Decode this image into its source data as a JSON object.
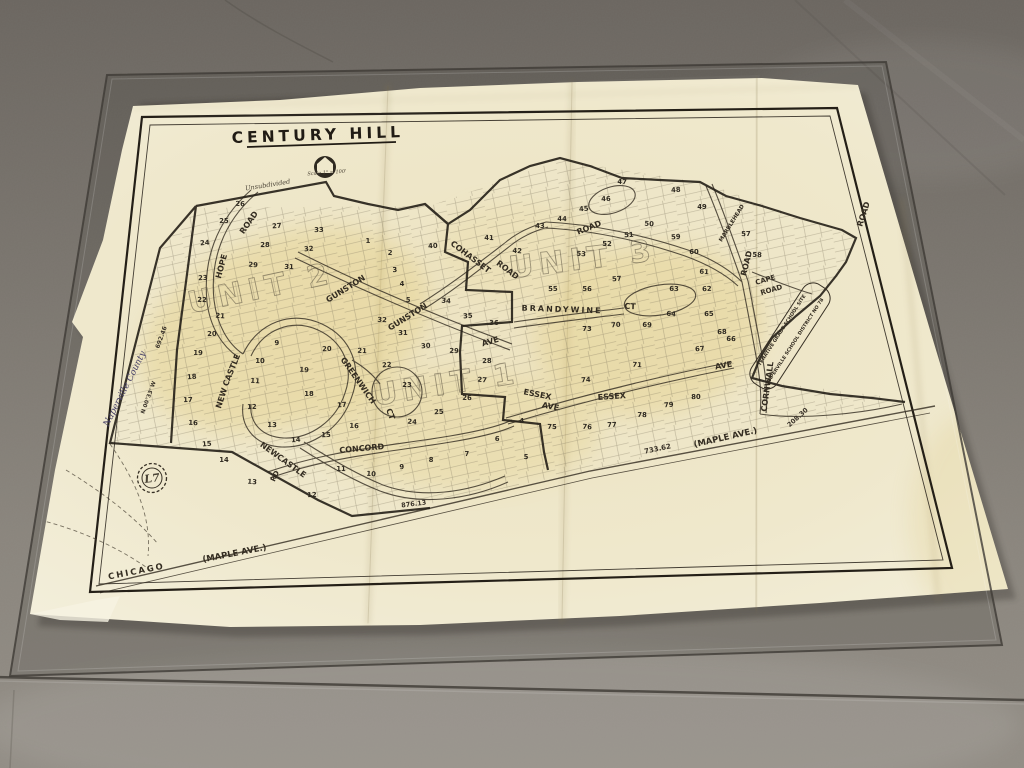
{
  "scene": {
    "description": "Photograph of an old Century Hill subdivision plat map lying on a concrete floor under a sheet of glass",
    "palette": {
      "floor_dark": "#6c6761",
      "floor_mid": "#7d7871",
      "floor_light": "#8f8a82",
      "glass_tint": "#2d2a26",
      "paper": "#efe8cd",
      "paper_edge": "#f4f0e0",
      "aged_yellow": "#dec469",
      "ink": "#332c21",
      "script_ink": "#453f66"
    }
  },
  "map": {
    "title": "CENTURY HILL",
    "marker": {
      "label": "L7"
    },
    "units": [
      {
        "label": "UNIT 2",
        "x": 263,
        "y": 298,
        "r": -12
      },
      {
        "label": "UNIT 1",
        "x": 448,
        "y": 394,
        "r": -9
      },
      {
        "label": "UNIT 3",
        "x": 584,
        "y": 269,
        "r": -7
      }
    ],
    "streets": [
      {
        "label": "HOPE",
        "x": 224,
        "y": 267,
        "r": -75,
        "s": 8
      },
      {
        "label": "ROAD",
        "x": 251,
        "y": 224,
        "r": -55,
        "s": 8
      },
      {
        "label": "GUNSTON",
        "x": 347,
        "y": 291,
        "r": -32,
        "s": 8
      },
      {
        "label": "GUNSTON",
        "x": 409,
        "y": 319,
        "r": -32,
        "s": 8
      },
      {
        "label": "AVE",
        "x": 491,
        "y": 344,
        "r": -16,
        "s": 8
      },
      {
        "label": "COHASSET",
        "x": 469,
        "y": 259,
        "r": 37,
        "s": 8
      },
      {
        "label": "ROAD",
        "x": 506,
        "y": 272,
        "r": 37,
        "s": 8
      },
      {
        "label": "ROAD",
        "x": 590,
        "y": 230,
        "r": -22,
        "s": 8
      },
      {
        "label": "BRANDYWINE",
        "x": 562,
        "y": 312,
        "r": 2,
        "s": 8,
        "ls": 2
      },
      {
        "label": "CT",
        "x": 630,
        "y": 309,
        "r": 2,
        "s": 8
      },
      {
        "label": "MARBLEHEAD",
        "x": 733,
        "y": 224,
        "r": -58,
        "s": 5.5
      },
      {
        "label": "ROAD",
        "x": 749,
        "y": 264,
        "r": -76,
        "s": 8
      },
      {
        "label": "ROAD",
        "x": 866,
        "y": 215,
        "r": -72,
        "s": 8
      },
      {
        "label": "CAPE",
        "x": 766,
        "y": 282,
        "r": -16,
        "s": 7
      },
      {
        "label": "ROAD",
        "x": 772,
        "y": 292,
        "r": -16,
        "s": 7
      },
      {
        "label": "CORNWALL",
        "x": 770,
        "y": 387,
        "r": -82,
        "s": 8
      },
      {
        "label": "AVE",
        "x": 724,
        "y": 368,
        "r": -10,
        "s": 8
      },
      {
        "label": "ESSEX",
        "x": 537,
        "y": 397,
        "r": 11,
        "s": 8
      },
      {
        "label": "AVE",
        "x": 550,
        "y": 409,
        "r": 11,
        "s": 8
      },
      {
        "label": "ESSEX",
        "x": 612,
        "y": 399,
        "r": -4,
        "s": 8
      },
      {
        "label": "GREENWICH",
        "x": 356,
        "y": 382,
        "r": 55,
        "s": 8
      },
      {
        "label": "CT",
        "x": 388,
        "y": 415,
        "r": 70,
        "s": 8
      },
      {
        "label": "NEW",
        "x": 224,
        "y": 399,
        "r": -72,
        "s": 8
      },
      {
        "label": "CASTLE",
        "x": 234,
        "y": 371,
        "r": -68,
        "s": 8
      },
      {
        "label": "NEW",
        "x": 268,
        "y": 452,
        "r": 36,
        "s": 8
      },
      {
        "label": "CASTLE",
        "x": 290,
        "y": 468,
        "r": 36,
        "s": 8
      },
      {
        "label": "RD",
        "x": 277,
        "y": 477,
        "r": -65,
        "s": 7
      },
      {
        "label": "CONCORD",
        "x": 362,
        "y": 451,
        "r": -5,
        "s": 8
      },
      {
        "label": "CHICAGO",
        "x": 137,
        "y": 574,
        "r": -11,
        "s": 8.5,
        "ls": 2
      },
      {
        "label": "(MAPLE AVE.)",
        "x": 235,
        "y": 556,
        "r": -11,
        "s": 8.5
      },
      {
        "label": "(MAPLE AVE.)",
        "x": 726,
        "y": 440,
        "r": -13,
        "s": 8.5
      }
    ],
    "notes": [
      {
        "text": "Unsubdivided",
        "x": 268,
        "y": 187,
        "r": -9,
        "s": 6.5,
        "cls": "script"
      },
      {
        "text": "Scale 1\" = 100'",
        "x": 327,
        "y": 174,
        "r": -4,
        "s": 5,
        "cls": "script"
      },
      {
        "text": "Naperville County",
        "x": 127,
        "y": 390,
        "r": -63,
        "s": 9,
        "cls": "script-purple"
      },
      {
        "text": "TENATIVE GRADE SCHOOL SITE",
        "x": 783,
        "y": 331,
        "r": -57,
        "s": 4.8,
        "cls": "mlab"
      },
      {
        "text": "NAPERVILLE SCHOOL DISTRICT NO 78",
        "x": 796,
        "y": 342,
        "r": -57,
        "s": 4.8,
        "cls": "mlab"
      }
    ],
    "measurements": [
      {
        "text": "733.62",
        "x": 658,
        "y": 451,
        "r": -12,
        "s": 7
      },
      {
        "text": "208.30",
        "x": 799,
        "y": 419,
        "r": -42,
        "s": 6.5
      },
      {
        "text": "876.13",
        "x": 414,
        "y": 506,
        "r": -7,
        "s": 6.5
      },
      {
        "text": "692.46",
        "x": 163,
        "y": 338,
        "r": -70,
        "s": 6
      },
      {
        "text": "N 00°33' W",
        "x": 150,
        "y": 398,
        "r": -70,
        "s": 5.5
      }
    ],
    "lots": [
      {
        "n": "24",
        "x": 205,
        "y": 245
      },
      {
        "n": "25",
        "x": 224,
        "y": 223
      },
      {
        "n": "26",
        "x": 240,
        "y": 206
      },
      {
        "n": "27",
        "x": 277,
        "y": 228
      },
      {
        "n": "28",
        "x": 265,
        "y": 247
      },
      {
        "n": "29",
        "x": 253,
        "y": 267
      },
      {
        "n": "23",
        "x": 203,
        "y": 280
      },
      {
        "n": "22",
        "x": 202,
        "y": 302
      },
      {
        "n": "21",
        "x": 220,
        "y": 318
      },
      {
        "n": "20",
        "x": 212,
        "y": 336
      },
      {
        "n": "19",
        "x": 198,
        "y": 355
      },
      {
        "n": "18",
        "x": 192,
        "y": 379
      },
      {
        "n": "17",
        "x": 188,
        "y": 402
      },
      {
        "n": "16",
        "x": 193,
        "y": 425
      },
      {
        "n": "15",
        "x": 207,
        "y": 446
      },
      {
        "n": "14",
        "x": 224,
        "y": 462
      },
      {
        "n": "13",
        "x": 252,
        "y": 484
      },
      {
        "n": "9",
        "x": 277,
        "y": 345
      },
      {
        "n": "10",
        "x": 260,
        "y": 363
      },
      {
        "n": "11",
        "x": 255,
        "y": 383
      },
      {
        "n": "12",
        "x": 252,
        "y": 409
      },
      {
        "n": "13",
        "x": 272,
        "y": 427
      },
      {
        "n": "14",
        "x": 296,
        "y": 442
      },
      {
        "n": "15",
        "x": 326,
        "y": 437
      },
      {
        "n": "16",
        "x": 354,
        "y": 428
      },
      {
        "n": "17",
        "x": 342,
        "y": 407
      },
      {
        "n": "18",
        "x": 309,
        "y": 396
      },
      {
        "n": "19",
        "x": 304,
        "y": 372
      },
      {
        "n": "20",
        "x": 327,
        "y": 351
      },
      {
        "n": "11",
        "x": 341,
        "y": 471
      },
      {
        "n": "10",
        "x": 371,
        "y": 476
      },
      {
        "n": "12",
        "x": 312,
        "y": 497
      },
      {
        "n": "31",
        "x": 289,
        "y": 269
      },
      {
        "n": "32",
        "x": 309,
        "y": 251
      },
      {
        "n": "33",
        "x": 319,
        "y": 232
      },
      {
        "n": "21",
        "x": 362,
        "y": 353
      },
      {
        "n": "22",
        "x": 387,
        "y": 367
      },
      {
        "n": "23",
        "x": 407,
        "y": 387
      },
      {
        "n": "24",
        "x": 412,
        "y": 424
      },
      {
        "n": "25",
        "x": 439,
        "y": 414
      },
      {
        "n": "26",
        "x": 467,
        "y": 400
      },
      {
        "n": "27",
        "x": 482,
        "y": 382
      },
      {
        "n": "28",
        "x": 487,
        "y": 363
      },
      {
        "n": "29",
        "x": 454,
        "y": 353
      },
      {
        "n": "30",
        "x": 426,
        "y": 348
      },
      {
        "n": "31",
        "x": 403,
        "y": 335
      },
      {
        "n": "32",
        "x": 382,
        "y": 322
      },
      {
        "n": "35",
        "x": 468,
        "y": 318
      },
      {
        "n": "36",
        "x": 494,
        "y": 325
      },
      {
        "n": "34",
        "x": 446,
        "y": 303
      },
      {
        "n": "4",
        "x": 522,
        "y": 423
      },
      {
        "n": "5",
        "x": 526,
        "y": 459
      },
      {
        "n": "6",
        "x": 497,
        "y": 441
      },
      {
        "n": "7",
        "x": 467,
        "y": 456
      },
      {
        "n": "8",
        "x": 431,
        "y": 462
      },
      {
        "n": "9",
        "x": 402,
        "y": 469
      },
      {
        "n": "1",
        "x": 368,
        "y": 243
      },
      {
        "n": "2",
        "x": 390,
        "y": 255
      },
      {
        "n": "3",
        "x": 395,
        "y": 272
      },
      {
        "n": "4",
        "x": 402,
        "y": 286
      },
      {
        "n": "5",
        "x": 408,
        "y": 302
      },
      {
        "n": "40",
        "x": 433,
        "y": 248
      },
      {
        "n": "41",
        "x": 489,
        "y": 240
      },
      {
        "n": "42",
        "x": 517,
        "y": 253
      },
      {
        "n": "43",
        "x": 540,
        "y": 228
      },
      {
        "n": "44",
        "x": 562,
        "y": 221
      },
      {
        "n": "45",
        "x": 584,
        "y": 211
      },
      {
        "n": "46",
        "x": 606,
        "y": 201
      },
      {
        "n": "47",
        "x": 622,
        "y": 184
      },
      {
        "n": "48",
        "x": 676,
        "y": 192
      },
      {
        "n": "49",
        "x": 702,
        "y": 209
      },
      {
        "n": "50",
        "x": 649,
        "y": 226
      },
      {
        "n": "51",
        "x": 629,
        "y": 237
      },
      {
        "n": "52",
        "x": 607,
        "y": 246
      },
      {
        "n": "53",
        "x": 581,
        "y": 256
      },
      {
        "n": "55",
        "x": 553,
        "y": 291
      },
      {
        "n": "56",
        "x": 587,
        "y": 291
      },
      {
        "n": "57",
        "x": 617,
        "y": 281
      },
      {
        "n": "57",
        "x": 746,
        "y": 236
      },
      {
        "n": "58",
        "x": 757,
        "y": 257
      },
      {
        "n": "59",
        "x": 676,
        "y": 239
      },
      {
        "n": "60",
        "x": 694,
        "y": 254
      },
      {
        "n": "61",
        "x": 704,
        "y": 274
      },
      {
        "n": "62",
        "x": 707,
        "y": 291
      },
      {
        "n": "63",
        "x": 674,
        "y": 291
      },
      {
        "n": "64",
        "x": 671,
        "y": 316
      },
      {
        "n": "65",
        "x": 709,
        "y": 316
      },
      {
        "n": "66",
        "x": 731,
        "y": 341
      },
      {
        "n": "67",
        "x": 700,
        "y": 351
      },
      {
        "n": "68",
        "x": 722,
        "y": 334
      },
      {
        "n": "69",
        "x": 647,
        "y": 327
      },
      {
        "n": "70",
        "x": 616,
        "y": 327
      },
      {
        "n": "73",
        "x": 587,
        "y": 331
      },
      {
        "n": "71",
        "x": 637,
        "y": 367
      },
      {
        "n": "74",
        "x": 586,
        "y": 382
      },
      {
        "n": "75",
        "x": 552,
        "y": 429
      },
      {
        "n": "76",
        "x": 587,
        "y": 429
      },
      {
        "n": "77",
        "x": 612,
        "y": 427
      },
      {
        "n": "78",
        "x": 642,
        "y": 417
      },
      {
        "n": "79",
        "x": 669,
        "y": 407
      },
      {
        "n": "80",
        "x": 696,
        "y": 399
      }
    ]
  }
}
